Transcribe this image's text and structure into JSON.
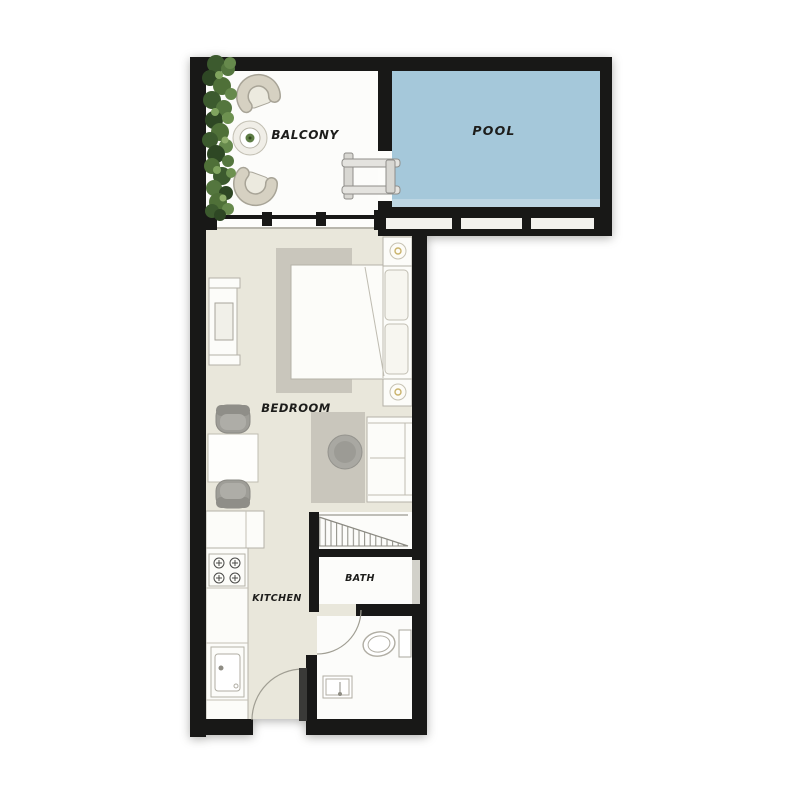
{
  "plan": {
    "rooms": [
      {
        "id": "balcony",
        "label": "BALCONY"
      },
      {
        "id": "pool",
        "label": "POOL"
      },
      {
        "id": "bedroom",
        "label": "BEDROOM"
      },
      {
        "id": "kitchen",
        "label": "KITCHEN"
      },
      {
        "id": "bath",
        "label": "BATH"
      }
    ],
    "colors": {
      "wall": "#181817",
      "pool_water": "#a5c8da",
      "pool_water_shallow": "#bdd6e3",
      "floor_main": "#e9e7db",
      "floor_light": "#fcfcfa",
      "rug": "#c9c6bc",
      "ottoman": "#a9a8a2",
      "chair_gray": "#9e9d97",
      "armchair_beige": "#d6d1c2",
      "greenery_dark": "#2e4724",
      "greenery_mid": "#4f7038",
      "greenery_light": "#6d9150",
      "label_text": "#1d1d1b",
      "pool_label_text": "#14212e"
    }
  }
}
